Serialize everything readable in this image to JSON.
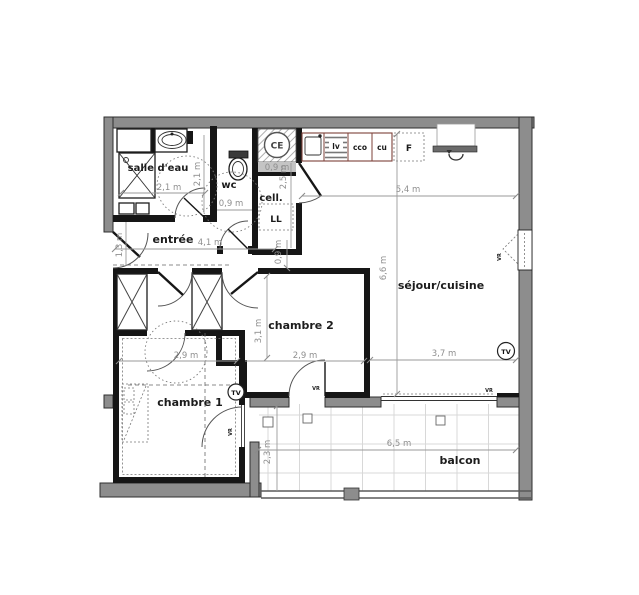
{
  "rooms": {
    "salle_deau": "salle d'eau",
    "wc": "wc",
    "cellier": "cell.",
    "entree": "entrée",
    "chambre2": "chambre 2",
    "chambre1": "chambre 1",
    "sejour": "séjour/cuisine",
    "balcon": "balcon"
  },
  "equipment": {
    "water_heater": "CE",
    "washing_machine": "LL",
    "dishwasher": "lv",
    "hob": "cco",
    "oven": "cu",
    "fridge": "F",
    "tv_outlet": "TV",
    "roller_shutter": "VR"
  },
  "dimensions": {
    "ce_width": "0,9 m",
    "cell_height": "2,5 m",
    "sdb_width": "2,1 m",
    "sdb_depth": "2,1 m",
    "wc_width": "0,9 m",
    "entree_width": "1,3 m",
    "hall_length": "4,1 m",
    "ch2_door": "0,9 m",
    "sejour_width": "5,4 m",
    "sejour_length": "6,6 m",
    "ch2_depth": "3,1 m",
    "ch1_width": "2,9 m",
    "ch2_width": "2,9 m",
    "sejour_lower_width": "3,7 m",
    "balcon_length": "6,5 m",
    "balcon_depth": "2,3 m"
  },
  "colors": {
    "exterior_wall": "#8d8d8d",
    "interior_wall": "#161616",
    "dimension_text": "#8f8f8f",
    "counter_outline": "#7c4038",
    "balcony_grid": "#d8d8d8",
    "label_text": "#1c1c1c"
  }
}
